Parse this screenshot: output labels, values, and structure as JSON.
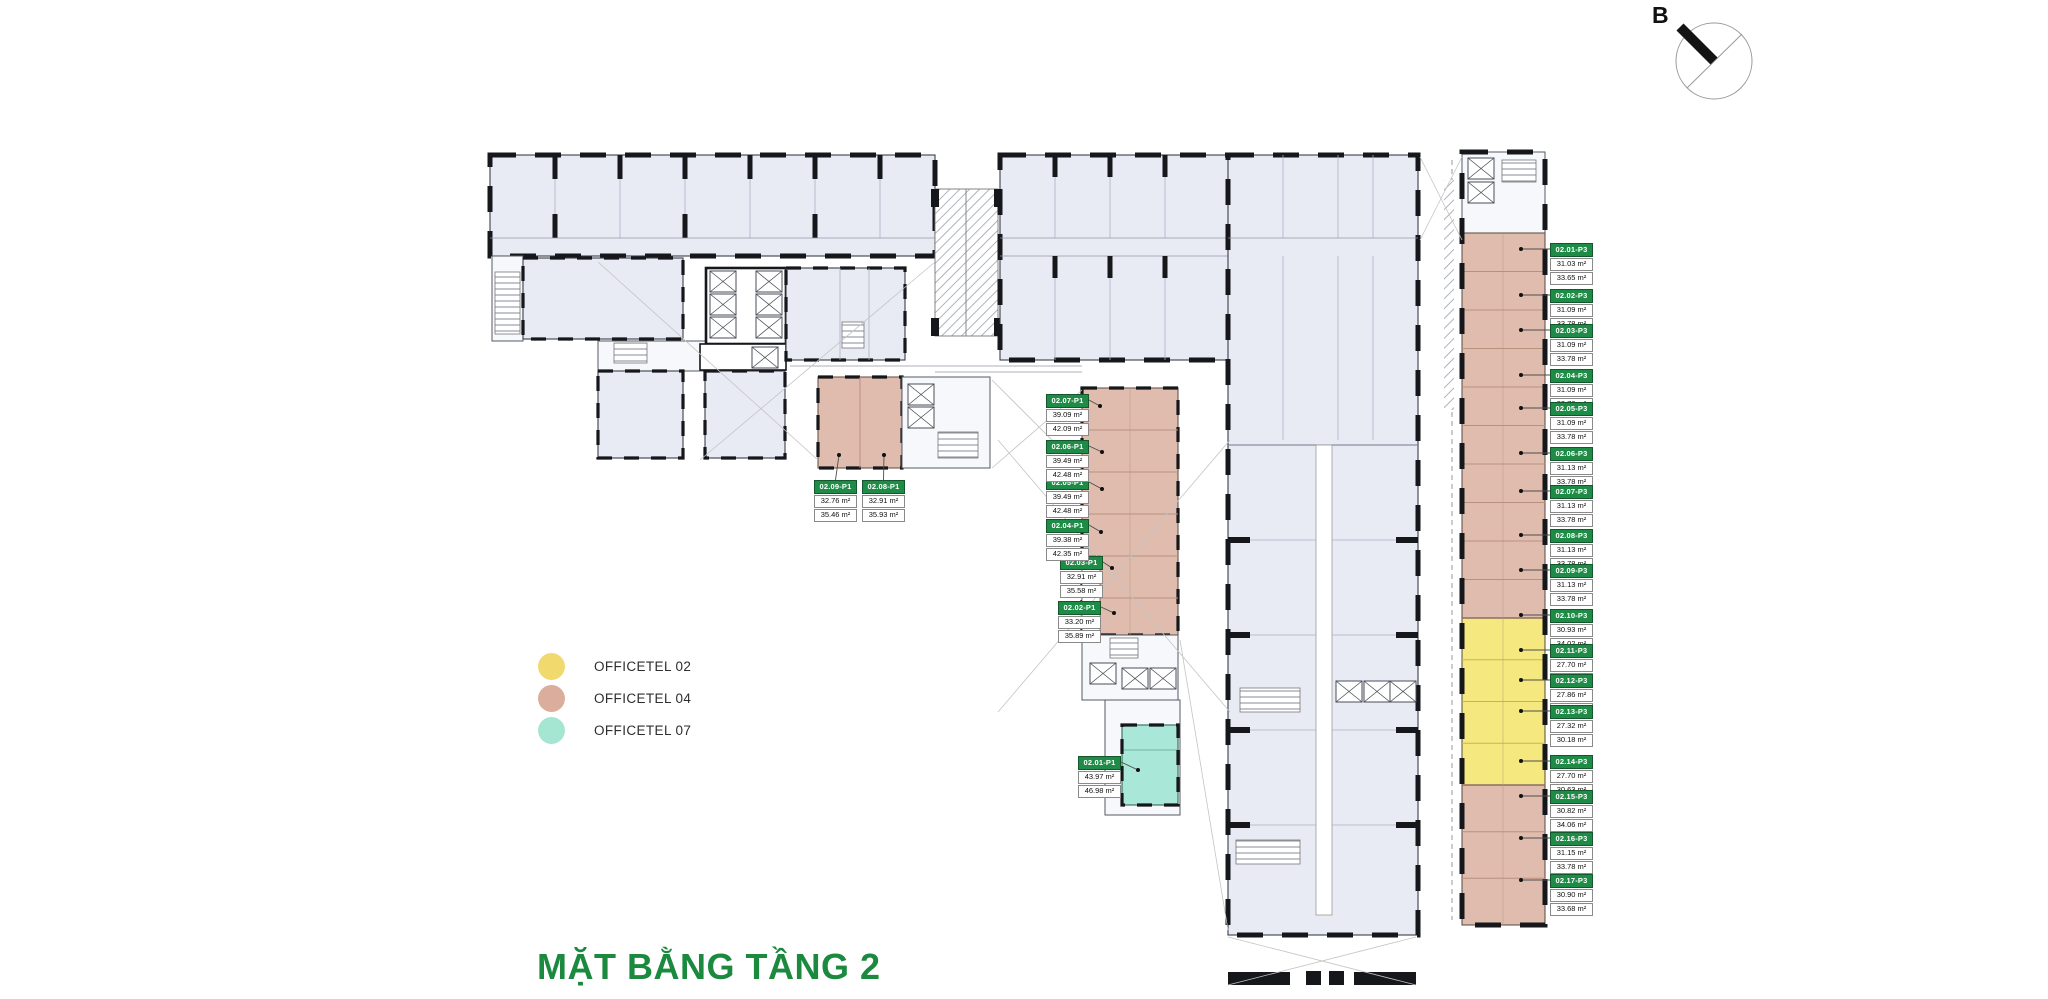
{
  "title": "MẶT BẰNG TẦNG 2",
  "compass": {
    "label": "B"
  },
  "legend": {
    "items": [
      {
        "label": "OFFICETEL 02",
        "color": "#F2D96E"
      },
      {
        "label": "OFFICETEL 04",
        "color": "#DBAD9D"
      },
      {
        "label": "OFFICETEL 07",
        "color": "#A5E6D2"
      }
    ]
  },
  "colors": {
    "room_fill": "#E9EBF4",
    "unit_yellow": "#F5E87E",
    "unit_salmon": "#DFBCAD",
    "unit_teal": "#A9E8D8",
    "label_green": "#1E8C46",
    "title_green": "#1B8A3F"
  },
  "units_p1": [
    {
      "id": "02.01-P1",
      "area1": "43.97 m²",
      "area2": "46.98 m²"
    },
    {
      "id": "02.02-P1",
      "area1": "33.20 m²",
      "area2": "35.89 m²"
    },
    {
      "id": "02.03-P1",
      "area1": "32.91 m²",
      "area2": "35.58 m²"
    },
    {
      "id": "02.04-P1",
      "area1": "39.38 m²",
      "area2": "42.35 m²"
    },
    {
      "id": "02.05-P1",
      "area1": "39.49 m²",
      "area2": "42.48 m²"
    },
    {
      "id": "02.06-P1",
      "area1": "39.49 m²",
      "area2": "42.48 m²"
    },
    {
      "id": "02.07-P1",
      "area1": "39.09 m²",
      "area2": "42.09 m²"
    },
    {
      "id": "02.08-P1",
      "area1": "32.91 m²",
      "area2": "35.93 m²"
    },
    {
      "id": "02.09-P1",
      "area1": "32.76 m²",
      "area2": "35.46 m²"
    }
  ],
  "units_p3": [
    {
      "id": "02.01-P3",
      "area1": "31.03 m²",
      "area2": "33.65 m²"
    },
    {
      "id": "02.02-P3",
      "area1": "31.09 m²",
      "area2": "33.78 m²"
    },
    {
      "id": "02.03-P3",
      "area1": "31.09 m²",
      "area2": "33.78 m²"
    },
    {
      "id": "02.04-P3",
      "area1": "31.09 m²",
      "area2": "33.78 m²"
    },
    {
      "id": "02.05-P3",
      "area1": "31.09 m²",
      "area2": "33.78 m²"
    },
    {
      "id": "02.06-P3",
      "area1": "31.13 m²",
      "area2": "33.78 m²"
    },
    {
      "id": "02.07-P3",
      "area1": "31.13 m²",
      "area2": "33.78 m²"
    },
    {
      "id": "02.08-P3",
      "area1": "31.13 m²",
      "area2": "33.78 m²"
    },
    {
      "id": "02.09-P3",
      "area1": "31.13 m²",
      "area2": "33.78 m²"
    },
    {
      "id": "02.10-P3",
      "area1": "30.93 m²",
      "area2": "34.02 m²"
    },
    {
      "id": "02.11-P3",
      "area1": "27.70 m²",
      "area2": "30.63 m²"
    },
    {
      "id": "02.12-P3",
      "area1": "27.86 m²",
      "area2": "30.80 m²"
    },
    {
      "id": "02.13-P3",
      "area1": "27.32 m²",
      "area2": "30.18 m²"
    },
    {
      "id": "02.14-P3",
      "area1": "27.70 m²",
      "area2": "30.63 m²"
    },
    {
      "id": "02.15-P3",
      "area1": "30.82 m²",
      "area2": "34.06 m²"
    },
    {
      "id": "02.16-P3",
      "area1": "31.15 m²",
      "area2": "33.78 m²"
    },
    {
      "id": "02.17-P3",
      "area1": "30.90 m²",
      "area2": "33.68 m²"
    }
  ]
}
